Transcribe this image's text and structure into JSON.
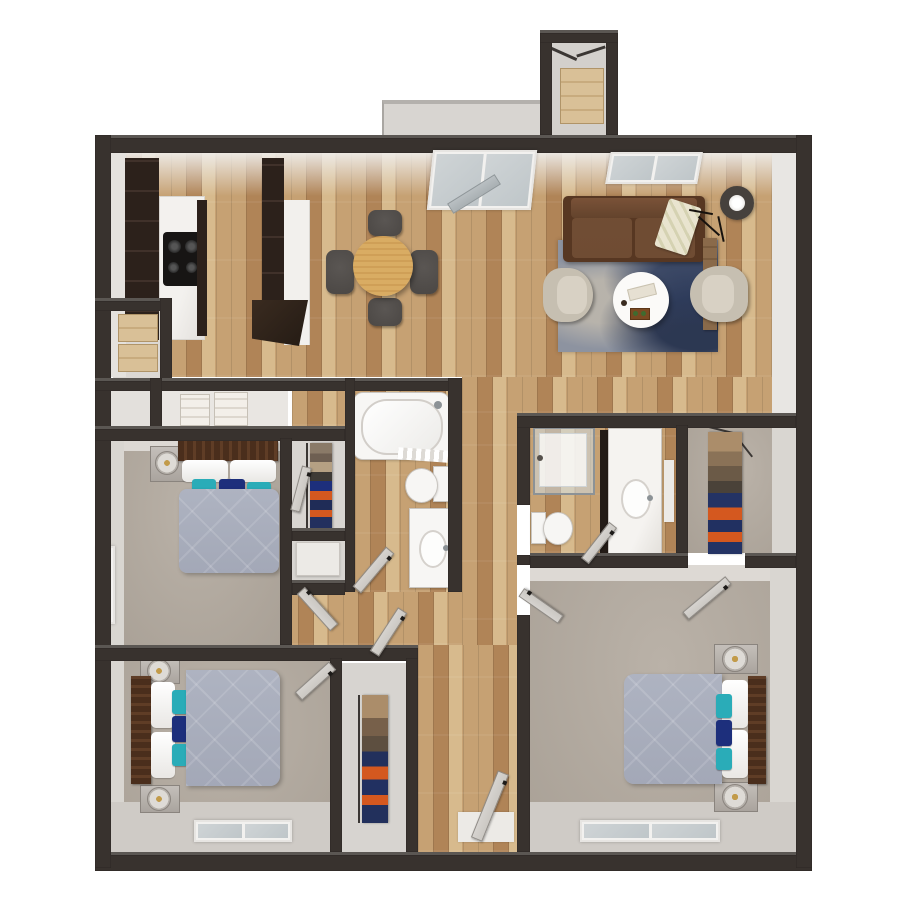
{
  "scene": {
    "type": "3d-floor-plan-render",
    "view": "top-down",
    "background": "#ffffff"
  },
  "palette": {
    "wall": "#38322e",
    "wallDark": "#2c2724",
    "face": "#eae8e5",
    "faceDim": "#d9d5d0",
    "faceLow": "#cfcbc6",
    "wood": "#c6a173",
    "woodDark": "#b08457",
    "woodLight": "#d7ba8d",
    "woodLine": "#9c7a50",
    "carpet": "#b2a99e",
    "closetFloor": "#d8d5d1",
    "concrete": "#d8d5d1",
    "cabinet": "#2c211b",
    "counter": "#f0eeea",
    "oak": "#d9ac63",
    "chair": "#4b4744",
    "sofa": "#6b4730",
    "sofaDark": "#573722",
    "rug": "#8d93a0",
    "rugNavy": "#2e3c5c",
    "duvet": "#a3a8b7",
    "headboard": "#4a2e1c",
    "white": "#f7f6f4",
    "teal": "#2aacb8",
    "navy": "#1d2f7c",
    "orange": "#d4581f",
    "tan": "#ab8d6a",
    "brown": "#77604a",
    "glass": "#c6cdd0",
    "leaf": "#cbc8c3",
    "gold": "#c29b4a",
    "lampRing": "#46413d",
    "cream": "#e9e4cf",
    "metal": "#8c9296"
  },
  "rooms": [
    {
      "id": "living-room",
      "label": "living room"
    },
    {
      "id": "dining-area",
      "label": "dining area"
    },
    {
      "id": "kitchen",
      "label": "kitchen"
    },
    {
      "id": "balcony",
      "label": "balcony"
    },
    {
      "id": "storage-closet",
      "label": "exterior storage closet"
    },
    {
      "id": "pantry-closet",
      "label": "pantry closet"
    },
    {
      "id": "linen-closet",
      "label": "linen closet"
    },
    {
      "id": "bedroom-1",
      "label": "bedroom one"
    },
    {
      "id": "bedroom-1-closet",
      "label": "bedroom one closet"
    },
    {
      "id": "bathroom-1",
      "label": "bathroom one"
    },
    {
      "id": "hallway",
      "label": "hallway"
    },
    {
      "id": "bedroom-2",
      "label": "bedroom two"
    },
    {
      "id": "bedroom-2-closet",
      "label": "bedroom two closet"
    },
    {
      "id": "bathroom-2",
      "label": "bathroom two"
    },
    {
      "id": "walk-in-closet",
      "label": "walk-in closet"
    },
    {
      "id": "master-bedroom",
      "label": "master bedroom"
    }
  ]
}
